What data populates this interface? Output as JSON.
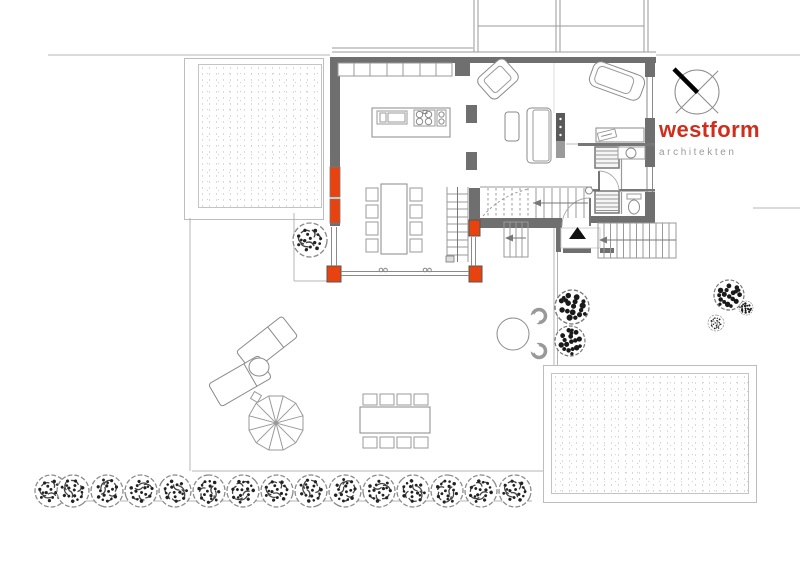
{
  "logo": {
    "title": "westform",
    "subtitle": "architekten"
  },
  "colors": {
    "accent_red": "#cf2e1d",
    "wall_orange": "#e8430e",
    "wall_gray": "#6f6f6f",
    "line_light": "#b4b4b4",
    "tree_ink": "#222222"
  },
  "compass": {
    "icon": "north-arrow-compass"
  },
  "site": {
    "tree_row": {
      "count": 15,
      "y": 491,
      "radius": 16,
      "x_positions": [
        51,
        73,
        107,
        141,
        175,
        209,
        243,
        277,
        311,
        345,
        379,
        413,
        447,
        481,
        515
      ]
    },
    "bushes": [
      {
        "x": 310,
        "y": 240,
        "r": 17,
        "variant": "tree"
      },
      {
        "x": 572,
        "y": 307,
        "r": 17,
        "variant": "bush-dark"
      },
      {
        "x": 570,
        "y": 341,
        "r": 15,
        "variant": "bush-dark"
      },
      {
        "x": 729,
        "y": 295,
        "r": 15,
        "variant": "bush-dark"
      },
      {
        "x": 746,
        "y": 308,
        "r": 7,
        "variant": "bush-dark"
      },
      {
        "x": 716,
        "y": 323,
        "r": 8,
        "variant": "tree"
      }
    ]
  }
}
